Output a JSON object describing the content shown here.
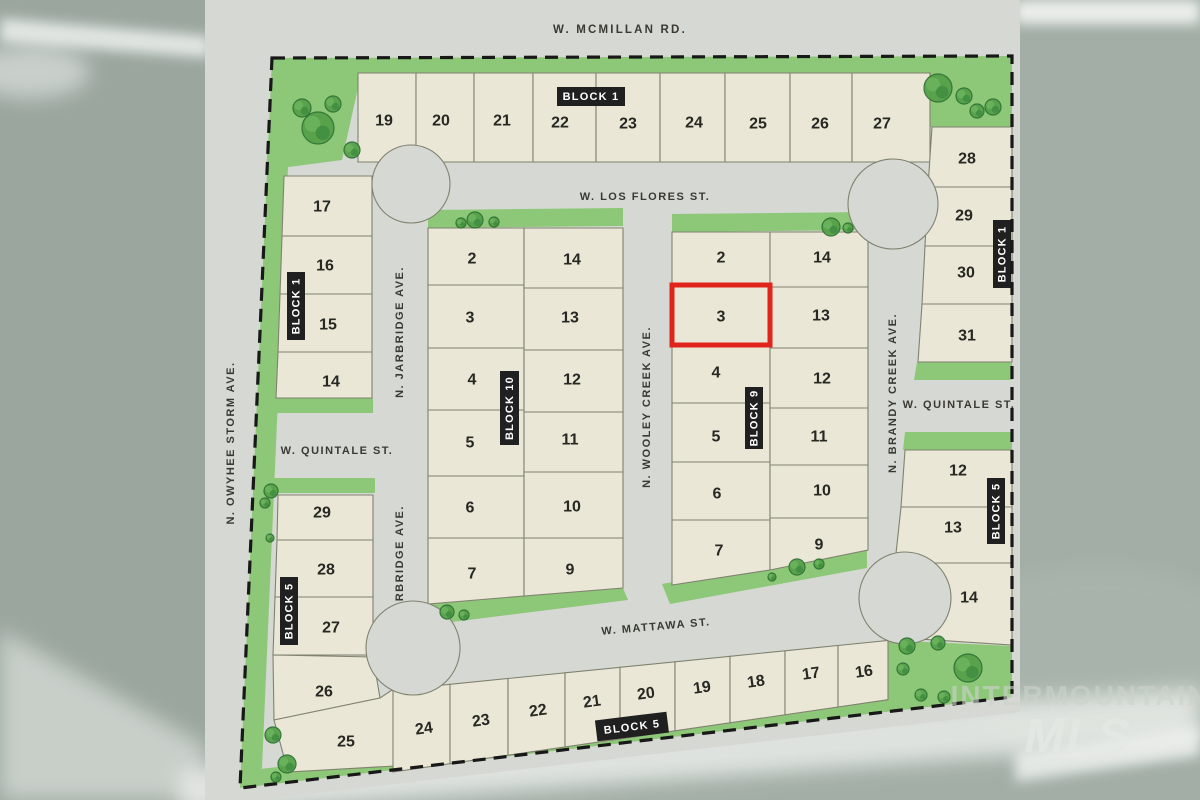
{
  "map": {
    "streets": {
      "mcmillan": "W. MCMILLAN RD.",
      "los_flores": "W. LOS FLORES ST.",
      "quintale": "W. QUINTALE ST.",
      "mattawa": "W. MATTAWA ST.",
      "owyhee_storm": "N. OWYHEE STORM AVE.",
      "jarbridge": "N. JARBRIDGE AVE.",
      "wooley_creek": "N. WOOLEY CREEK AVE.",
      "brandy_creek": "N. BRANDY CREEK AVE."
    },
    "blocks": {
      "block1_north": {
        "label": "BLOCK 1",
        "lots": [
          "19",
          "20",
          "21",
          "22",
          "23",
          "24",
          "25",
          "26",
          "27"
        ]
      },
      "block1_west": {
        "label": "BLOCK 1",
        "lots": [
          "17",
          "16",
          "15",
          "14"
        ]
      },
      "block1_east": {
        "label": "BLOCK 1",
        "lots": [
          "28",
          "29",
          "30",
          "31"
        ]
      },
      "block10": {
        "label": "BLOCK 10",
        "lots_west": [
          "2",
          "3",
          "4",
          "5",
          "6",
          "7"
        ],
        "lots_east": [
          "14",
          "13",
          "12",
          "11",
          "10",
          "9"
        ]
      },
      "block9": {
        "label": "BLOCK 9",
        "lots_west": [
          "2",
          "3",
          "4",
          "5",
          "6",
          "7"
        ],
        "lots_east": [
          "14",
          "13",
          "12",
          "11",
          "10",
          "9"
        ],
        "highlighted_lot": "3"
      },
      "block5_west": {
        "label": "BLOCK 5",
        "lots": [
          "29",
          "28",
          "27",
          "26",
          "25"
        ]
      },
      "block5_south": {
        "label": "BLOCK 5",
        "lots": [
          "24",
          "23",
          "22",
          "21",
          "20",
          "19",
          "18",
          "17",
          "16"
        ]
      },
      "block5_east": {
        "label": "BLOCK 5",
        "lots": [
          "12",
          "13",
          "14"
        ]
      }
    },
    "highlight_color": "#e0241c"
  },
  "watermark": {
    "line1": "INTERMOUNTAIN",
    "line2": "MLS"
  },
  "colors": {
    "lot_fill": "#eae7d7",
    "street_gray": "#d6d8d3",
    "green": "#8dc878",
    "tree_green": "#55a149",
    "boundary": "#181818",
    "label_bg": "#202020",
    "label_text": "#ffffff",
    "photo_sage": "#a2aea6",
    "highlight": "#e0241c"
  }
}
